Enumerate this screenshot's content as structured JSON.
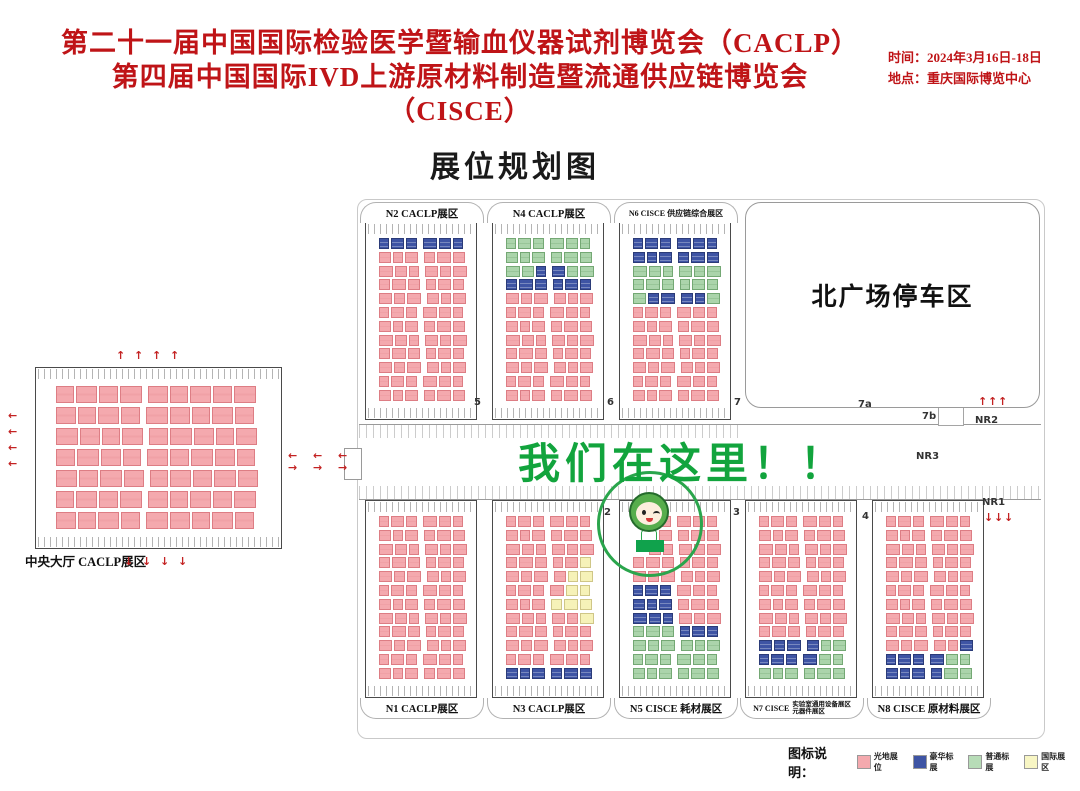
{
  "header": {
    "title_line1": "第二十一届中国国际检验医学暨输血仪器试剂博览会（CACLP）",
    "title_line2": "第四届中国国际IVD上游原材料制造暨流通供应链博览会（CISCE）",
    "time": "时间：2024年3月16日-18日",
    "location": "地点：重庆国际博览中心",
    "title_color": "#bf1417"
  },
  "map_title": "展位规划图",
  "overlay": {
    "text": "我们在这里！！",
    "color": "#12a43d"
  },
  "parking_label": "北广场停车区",
  "central_hall": {
    "label": "中央大厅 CACLP展区",
    "rows": [
      "PPPPPPPPP",
      "PPPPPPPPP",
      "PPPPPPPPP",
      "PPPPPPPPP",
      "PPPPPPPPP",
      "PPPPPPPPP",
      "PPPPPPPPP"
    ]
  },
  "halls": [
    {
      "id": "N2",
      "row": "top",
      "x": 365,
      "label": "N2 CACLP展区",
      "rows": [
        "BBBBBB",
        "PPPPPP",
        "PPPPPP",
        "PPPPPP",
        "PPPPPP",
        "PPPPPP",
        "PPPPPP",
        "PPPPPP",
        "PPPPPP",
        "PPPPPP",
        "PPPPPP",
        "PPPPPP"
      ]
    },
    {
      "id": "N4",
      "row": "top",
      "x": 492,
      "label": "N4 CACLP展区",
      "rows": [
        "GGGGGG",
        "GGGGGG",
        "GGBBGG",
        "BBBBBB",
        "PPPPPP",
        "PPPPPP",
        "PPPPPP",
        "PPPPPP",
        "PPPPPP",
        "PPPPPP",
        "PPPPPP",
        "PPPPPP"
      ]
    },
    {
      "id": "N6",
      "row": "top",
      "x": 619,
      "label": "N6 CISCE 供应链综合展区",
      "label_small": true,
      "rows": [
        "BBBBBB",
        "BBBBBB",
        "GGGGGG",
        "GGGGGG",
        "GBBBBG",
        "PPPPPP",
        "PPPPPP",
        "PPPPPP",
        "PPPPPP",
        "PPPPPP",
        "PPPPPP",
        "PPPPPP"
      ]
    },
    {
      "id": "N1",
      "row": "bottom",
      "x": 365,
      "label": "N1 CACLP展区",
      "rows": [
        "PPPPPP",
        "PPPPPP",
        "PPPPPP",
        "PPPPPP",
        "PPPPPP",
        "PPPPPP",
        "PPPPPP",
        "PPPPPP",
        "PPPPPP",
        "PPPPPP",
        "PPPPPP",
        "PPPPPP"
      ]
    },
    {
      "id": "N3",
      "row": "bottom",
      "x": 492,
      "label": "N3 CACLP展区",
      "rows": [
        "PPPPPP",
        "PPPPPP",
        "PPPPPP",
        "PPPPPY",
        "PPPPYY",
        "PPPPYY",
        "PPPYYY",
        "PPPPPY",
        "PPPPPP",
        "PPPPPP",
        "PPPPPP",
        "BBBBBB"
      ]
    },
    {
      "id": "N5",
      "row": "bottom",
      "x": 619,
      "label": "N5 CISCE 耗材展区",
      "rows": [
        "..PPPP",
        "..PPPP",
        ".PPPPP",
        "PPPPPP",
        "PPPPPP",
        "BBBPPP",
        "BBBPPP",
        "BBBPPP",
        "GGGBBB",
        "GGGGGG",
        "GGGGGG",
        "GGGGGG"
      ]
    },
    {
      "id": "N7",
      "row": "bottom",
      "x": 745,
      "label": "N7 CISCE",
      "sublabels": [
        "实验室通用设备展区",
        "元器件展区"
      ],
      "rows": [
        "PPPPPP",
        "PPPPPP",
        "PPPPPP",
        "PPPPPP",
        "PPPPPP",
        "PPPPPP",
        "PPPPPP",
        "PPPPPP",
        "PPPPPP",
        "BBBBGG",
        "BBBBGG",
        "GGGGGG"
      ]
    },
    {
      "id": "N8",
      "row": "bottom",
      "x": 872,
      "label": "N8 CISCE 原材料展区",
      "rows": [
        "PPPPPP",
        "PPPPPP",
        "PPPPPP",
        "PPPPPP",
        "PPPPPP",
        "PPPPPP",
        "PPPPPP",
        "PPPPPP",
        "PPPPPP",
        "PPPPPB",
        "BBBBGG",
        "BBBBGG"
      ]
    }
  ],
  "corridor_labels": [
    {
      "t": "5",
      "x": 474,
      "y": 398
    },
    {
      "t": "6",
      "x": 607,
      "y": 398
    },
    {
      "t": "7",
      "x": 734,
      "y": 398
    },
    {
      "t": "7a",
      "x": 858,
      "y": 400
    },
    {
      "t": "7b",
      "x": 922,
      "y": 412
    },
    {
      "t": "NR2",
      "x": 975,
      "y": 416
    },
    {
      "t": "NR3",
      "x": 916,
      "y": 452
    },
    {
      "t": "NR1",
      "x": 982,
      "y": 498
    },
    {
      "t": "2",
      "x": 604,
      "y": 508
    },
    {
      "t": "3",
      "x": 733,
      "y": 508
    },
    {
      "t": "4",
      "x": 862,
      "y": 512
    }
  ],
  "arrows": [
    {
      "dir": "up",
      "x": 116,
      "y": 350,
      "n": 4,
      "gap": 18,
      "axis": "h"
    },
    {
      "dir": "down",
      "x": 124,
      "y": 556,
      "n": 4,
      "gap": 18,
      "axis": "h"
    },
    {
      "dir": "left",
      "x": 8,
      "y": 410,
      "n": 4,
      "gap": 16,
      "axis": "v"
    },
    {
      "dir": "left",
      "x": 288,
      "y": 450,
      "n": 3,
      "gap": 25,
      "axis": "h"
    },
    {
      "dir": "right",
      "x": 288,
      "y": 462,
      "n": 3,
      "gap": 25,
      "axis": "h"
    },
    {
      "dir": "up",
      "x": 978,
      "y": 396,
      "n": 3,
      "gap": 10,
      "axis": "h"
    },
    {
      "dir": "down",
      "x": 984,
      "y": 512,
      "n": 3,
      "gap": 10,
      "axis": "h"
    }
  ],
  "legend": {
    "title": "图标说明：",
    "items": [
      {
        "label": "光地展位",
        "color": "#f4a9ae"
      },
      {
        "label": "豪华标展",
        "color": "#3e54a4"
      },
      {
        "label": "普通标展",
        "color": "#b7dcb7"
      },
      {
        "label": "国际展区",
        "color": "#f8f6c4"
      }
    ]
  },
  "layout_meta": {
    "top_hall_y": 222,
    "bottom_hall_y": 500,
    "hall_h": 198,
    "hall_w": 112
  }
}
